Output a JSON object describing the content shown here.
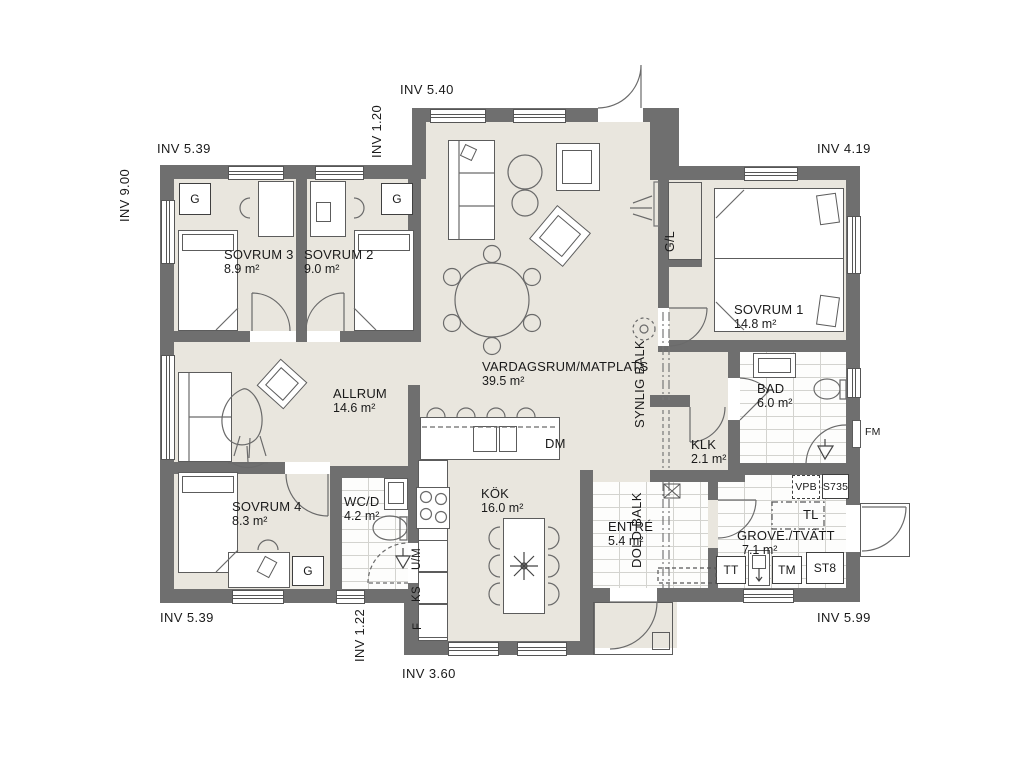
{
  "plan": {
    "dims": {
      "top_left": "INV 5.39",
      "top_mid": "INV 5.40",
      "top_right": "INV 4.19",
      "left": "INV 9.00",
      "left_offset": "INV 1.20",
      "bottom_left": "INV 5.39",
      "bottom_offset": "INV 1.22",
      "bottom_mid": "INV 3.60",
      "bottom_right": "INV 5.99"
    },
    "rooms": {
      "sovrum3": {
        "name": "SOVRUM 3",
        "area": "8.9 m²"
      },
      "sovrum2": {
        "name": "SOVRUM 2",
        "area": "9.0 m²"
      },
      "sovrum1": {
        "name": "SOVRUM 1",
        "area": "14.8 m²"
      },
      "sovrum4": {
        "name": "SOVRUM 4",
        "area": "8.3 m²"
      },
      "allrum": {
        "name": "ALLRUM",
        "area": "14.6 m²"
      },
      "vardagsrum": {
        "name": "VARDAGSRUM/MATPLATS",
        "area": "39.5 m²"
      },
      "kok": {
        "name": "KÖK",
        "area": "16.0 m²"
      },
      "wcd": {
        "name": "WC/D",
        "area": "4.2 m²"
      },
      "klk": {
        "name": "KLK",
        "area": "2.1 m²"
      },
      "bad": {
        "name": "BAD",
        "area": "6.0 m²"
      },
      "entre": {
        "name": "ENTRÉ",
        "area": "5.4 m²"
      },
      "grovtvatt": {
        "name": "GROVE./TVÄTT",
        "area": "7.1 m²"
      }
    },
    "beams": {
      "synlig": "SYNLIG BALK",
      "dold": "DOLD BALK"
    },
    "fixtures": {
      "g": "G",
      "gl": "G/L",
      "dm": "DM",
      "fm": "FM",
      "vpb": "VPB",
      "s735": "S735",
      "tl": "TL",
      "tt": "TT",
      "tm": "TM",
      "st8": "ST8",
      "f": "F",
      "ks": "KS",
      "um": "U/M"
    }
  }
}
